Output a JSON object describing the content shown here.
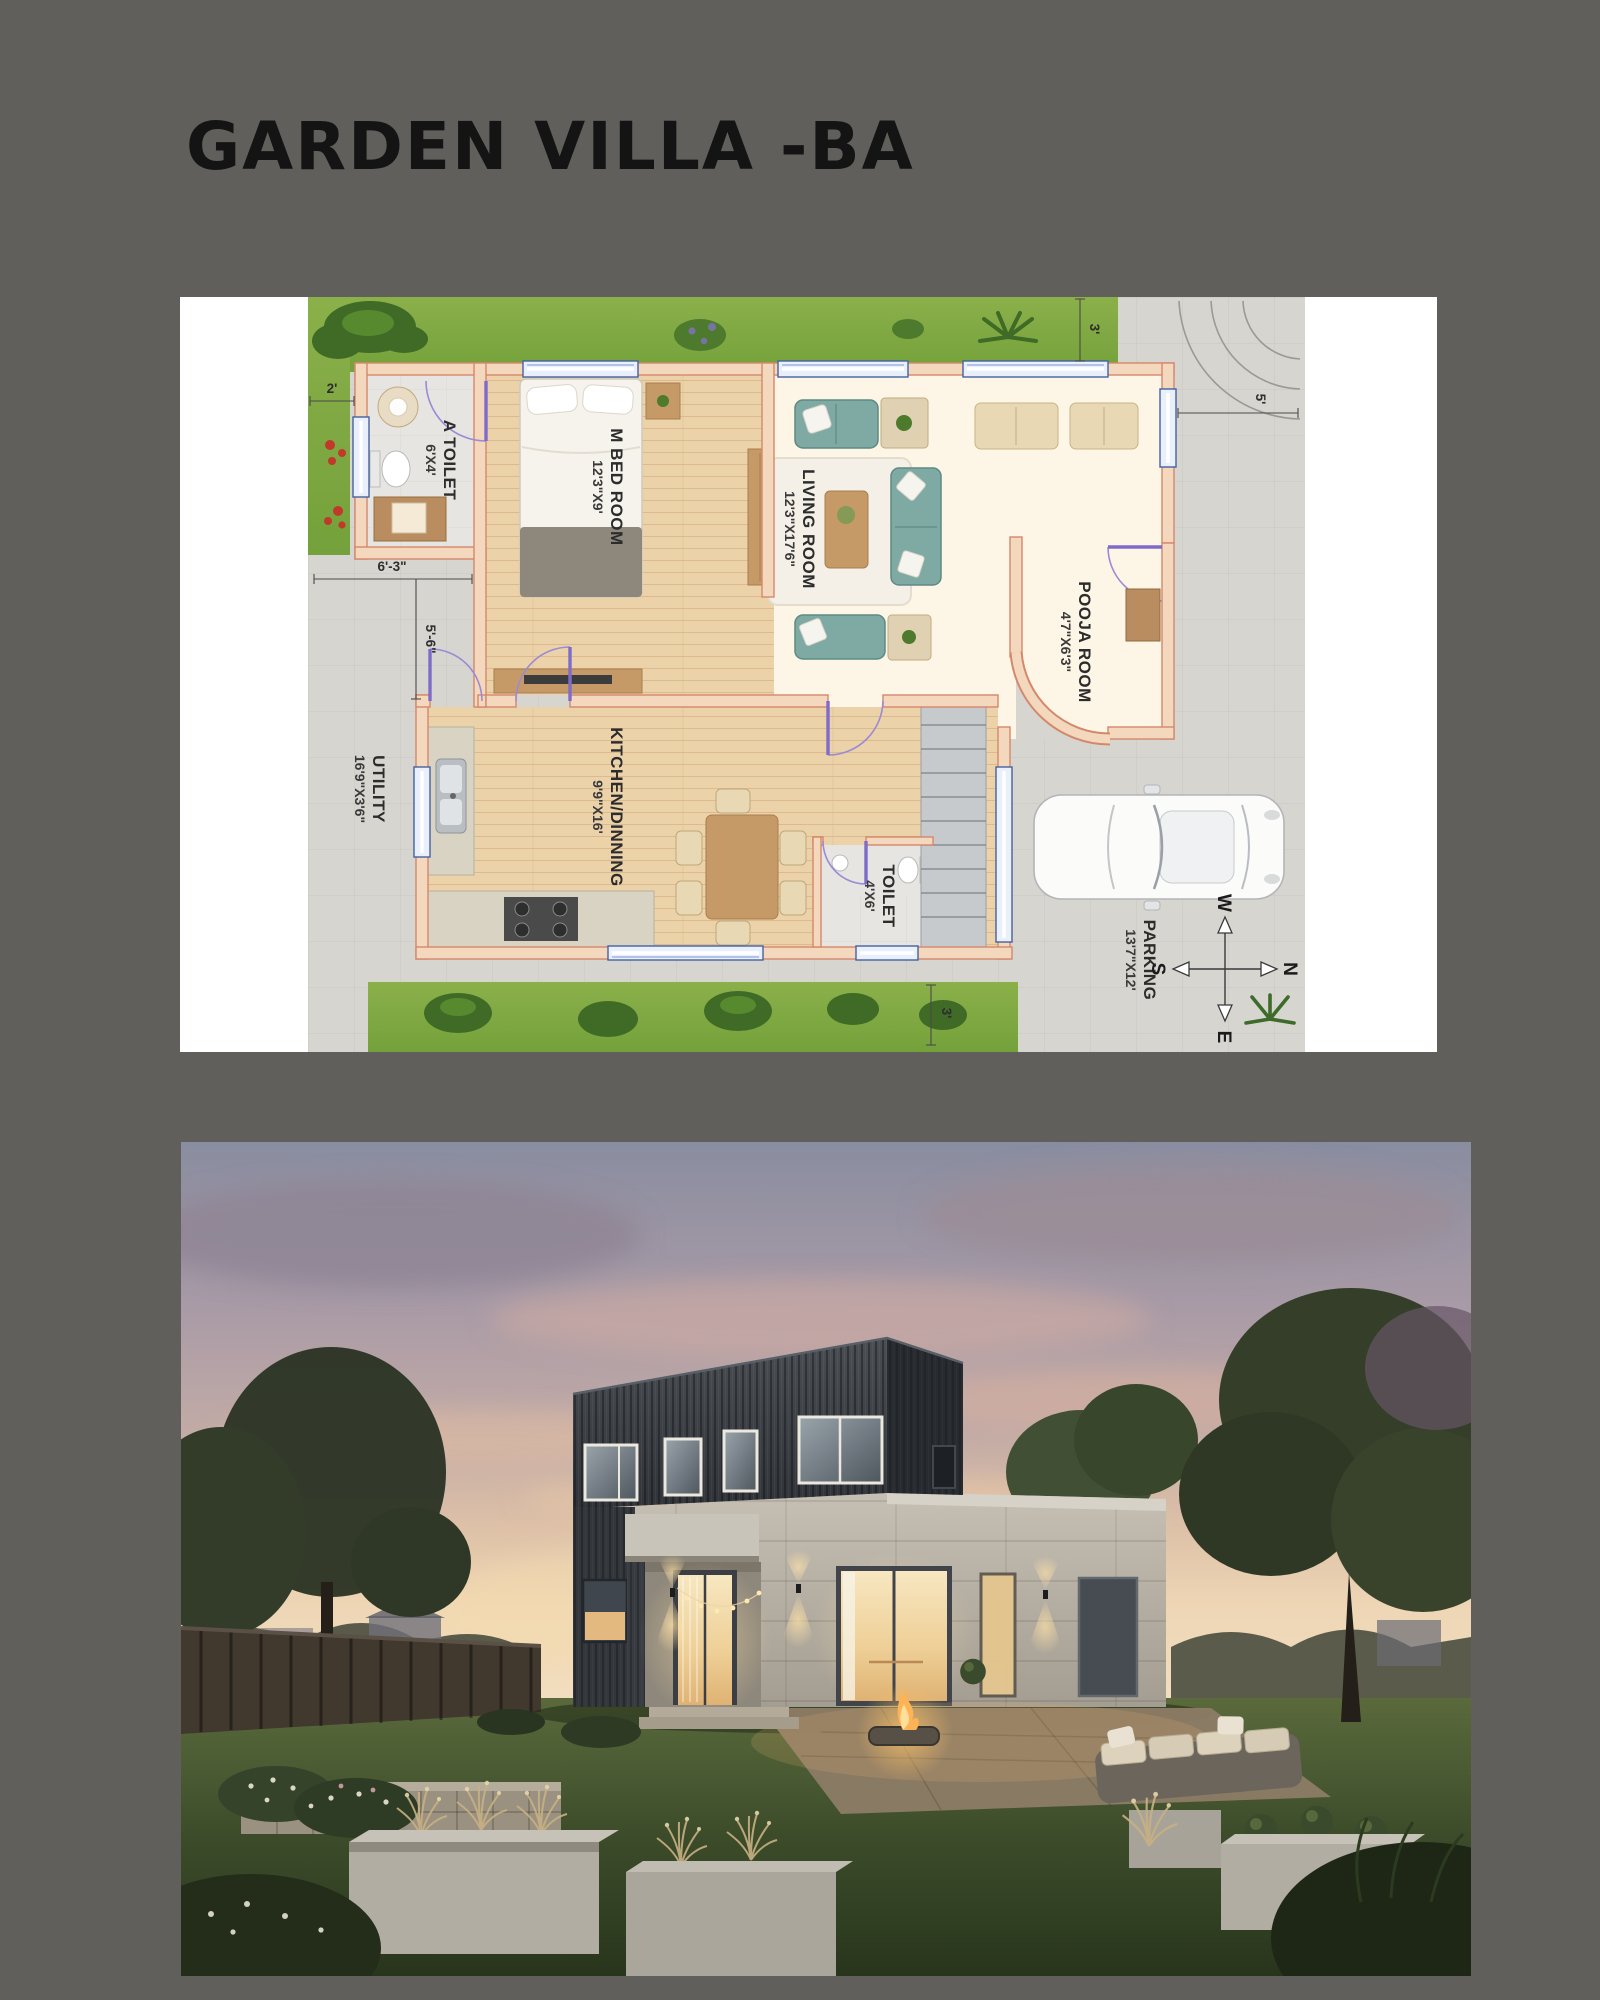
{
  "page": {
    "background_color": "#615f5c"
  },
  "header": {
    "title": "GARDEN VILLA -BA"
  },
  "floor_plan": {
    "rooms": [
      {
        "name": "A TOILET",
        "size": "6'X4'"
      },
      {
        "name": "M BED ROOM",
        "size": "12'3\"X9'"
      },
      {
        "name": "LIVING ROOM",
        "size": "12'3\"X17'6\""
      },
      {
        "name": "POOJA ROOM",
        "size": "4'7\"X6'3\""
      },
      {
        "name": "KITCHEN/DINNING",
        "size": "9'9\"X16'"
      },
      {
        "name": "TOILET",
        "size": "4'X6'"
      },
      {
        "name": "UTILITY",
        "size": "16'9\"X3'6\""
      },
      {
        "name": "PARKING",
        "size": "13'7\"X12'"
      }
    ],
    "dimensions": [
      "2'",
      "3'",
      "5'",
      "6'-3\"",
      "5'-6\"",
      "3'"
    ],
    "compass": {
      "west": "W",
      "south": "S",
      "north": "N",
      "east": "E"
    }
  }
}
